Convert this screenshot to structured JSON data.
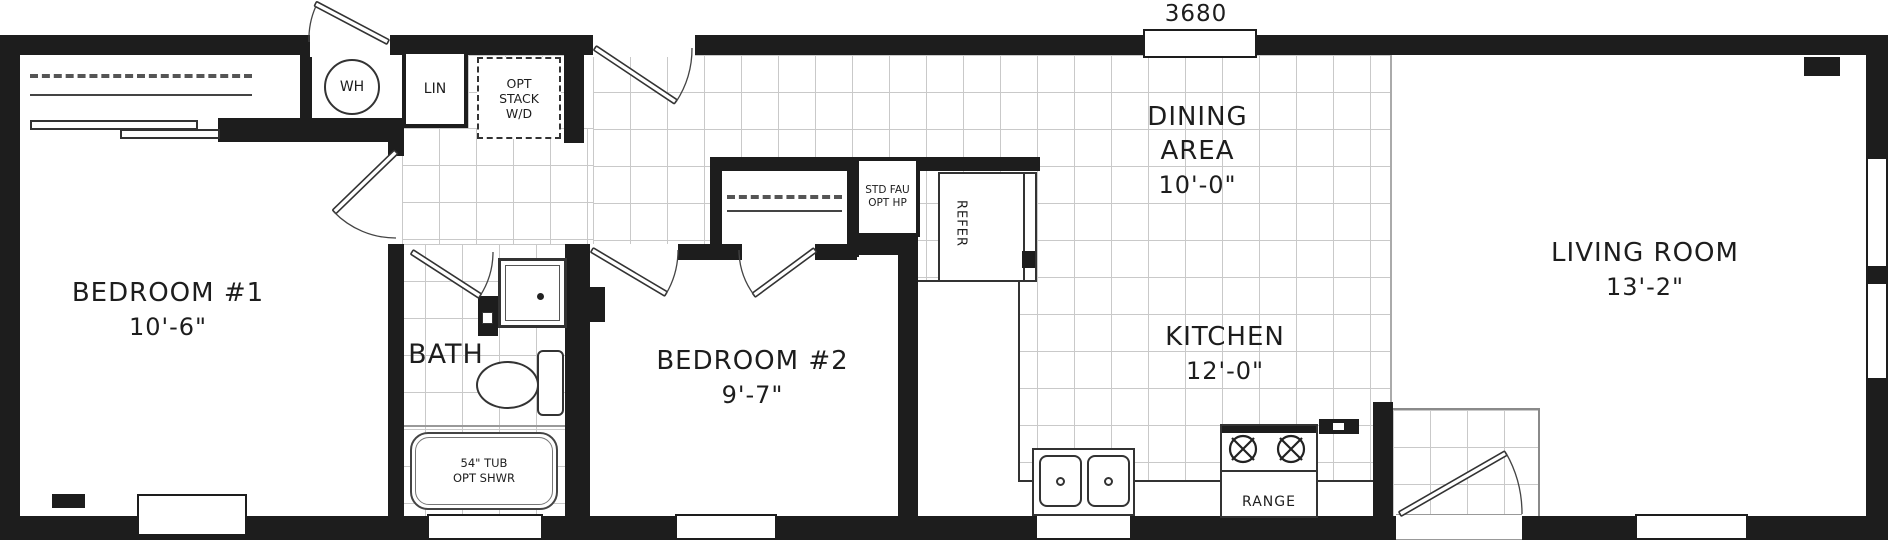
{
  "model": "3680",
  "rooms": {
    "bedroom1": {
      "name": "BEDROOM #1",
      "dim": "10'-6\""
    },
    "bath": {
      "name": "BATH"
    },
    "bedroom2": {
      "name": "BEDROOM #2",
      "dim": "9'-7\""
    },
    "kitchen": {
      "name": "KITCHEN",
      "dim": "12'-0\""
    },
    "dining": {
      "line1": "DINING",
      "line2": "AREA",
      "dim": "10'-0\""
    },
    "living": {
      "name": "LIVING ROOM",
      "dim": "13'-2\""
    }
  },
  "fixtures": {
    "water_heater": "WH",
    "linen": "LIN",
    "washer_dryer": {
      "line1": "OPT",
      "line2": "STACK",
      "line3": "W/D"
    },
    "furnace": {
      "line1": "STD FAU",
      "line2": "OPT HP"
    },
    "refrigerator": "REFER",
    "range": "RANGE",
    "tub": {
      "line1": "54\" TUB",
      "line2": "OPT SHWR"
    }
  },
  "colors": {
    "wall": "#1d1d1d",
    "tile_line": "#c9c9c9",
    "text": "#1d1d1d"
  }
}
